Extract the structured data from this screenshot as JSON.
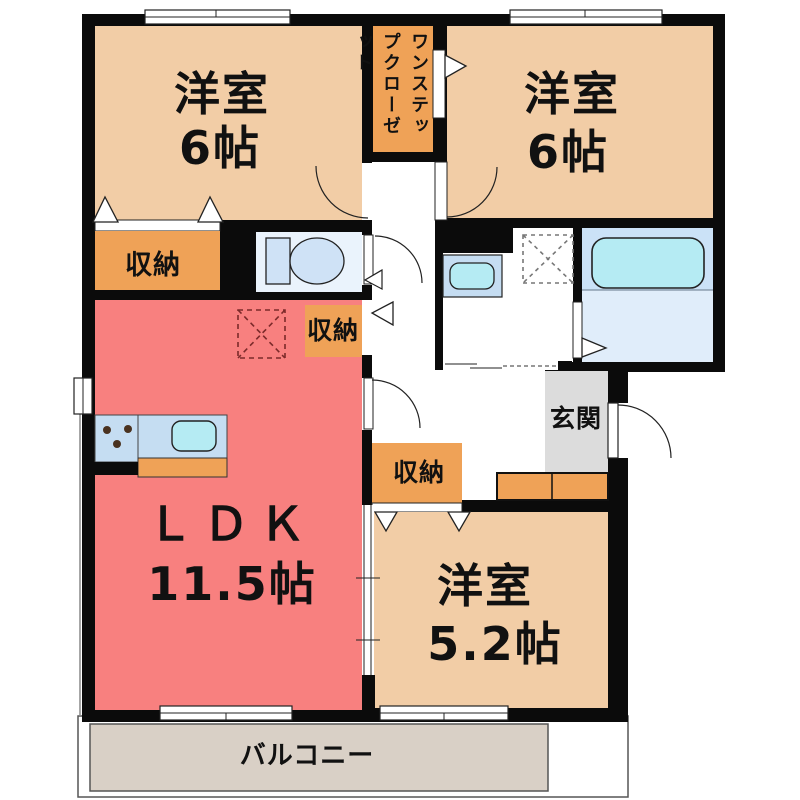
{
  "floorplan": {
    "bedroom_top_left": {
      "name": "洋室",
      "size": "6帖"
    },
    "bedroom_top_right": {
      "name": "洋室",
      "size": "6帖"
    },
    "ldk": {
      "name": "ＬＤＫ",
      "size": "11.5帖"
    },
    "bedroom_bottom": {
      "name": "洋室",
      "size": "5.2帖"
    },
    "closet": {
      "label": "ワンステップクローゼット"
    },
    "storage_left": {
      "label": "収納"
    },
    "storage_middle": {
      "label": "収納"
    },
    "storage_bottom": {
      "label": "収納"
    },
    "entrance": {
      "label": "玄関"
    },
    "balcony": {
      "label": "バルコニー"
    },
    "colors": {
      "wall": "#0b0b0b",
      "bedroom": "#f2cda6",
      "ldk": "#f8807f",
      "storage": "#efa257",
      "balcony": "#d9d0c6",
      "entrance": "#dcdcdc",
      "bath_upper": "#cbe2f7",
      "bath_lower": "#e0edfa",
      "toilet_floor": "#eaf3fc",
      "counter": "#c5ddf2",
      "basin": "#b5ebf3"
    }
  }
}
